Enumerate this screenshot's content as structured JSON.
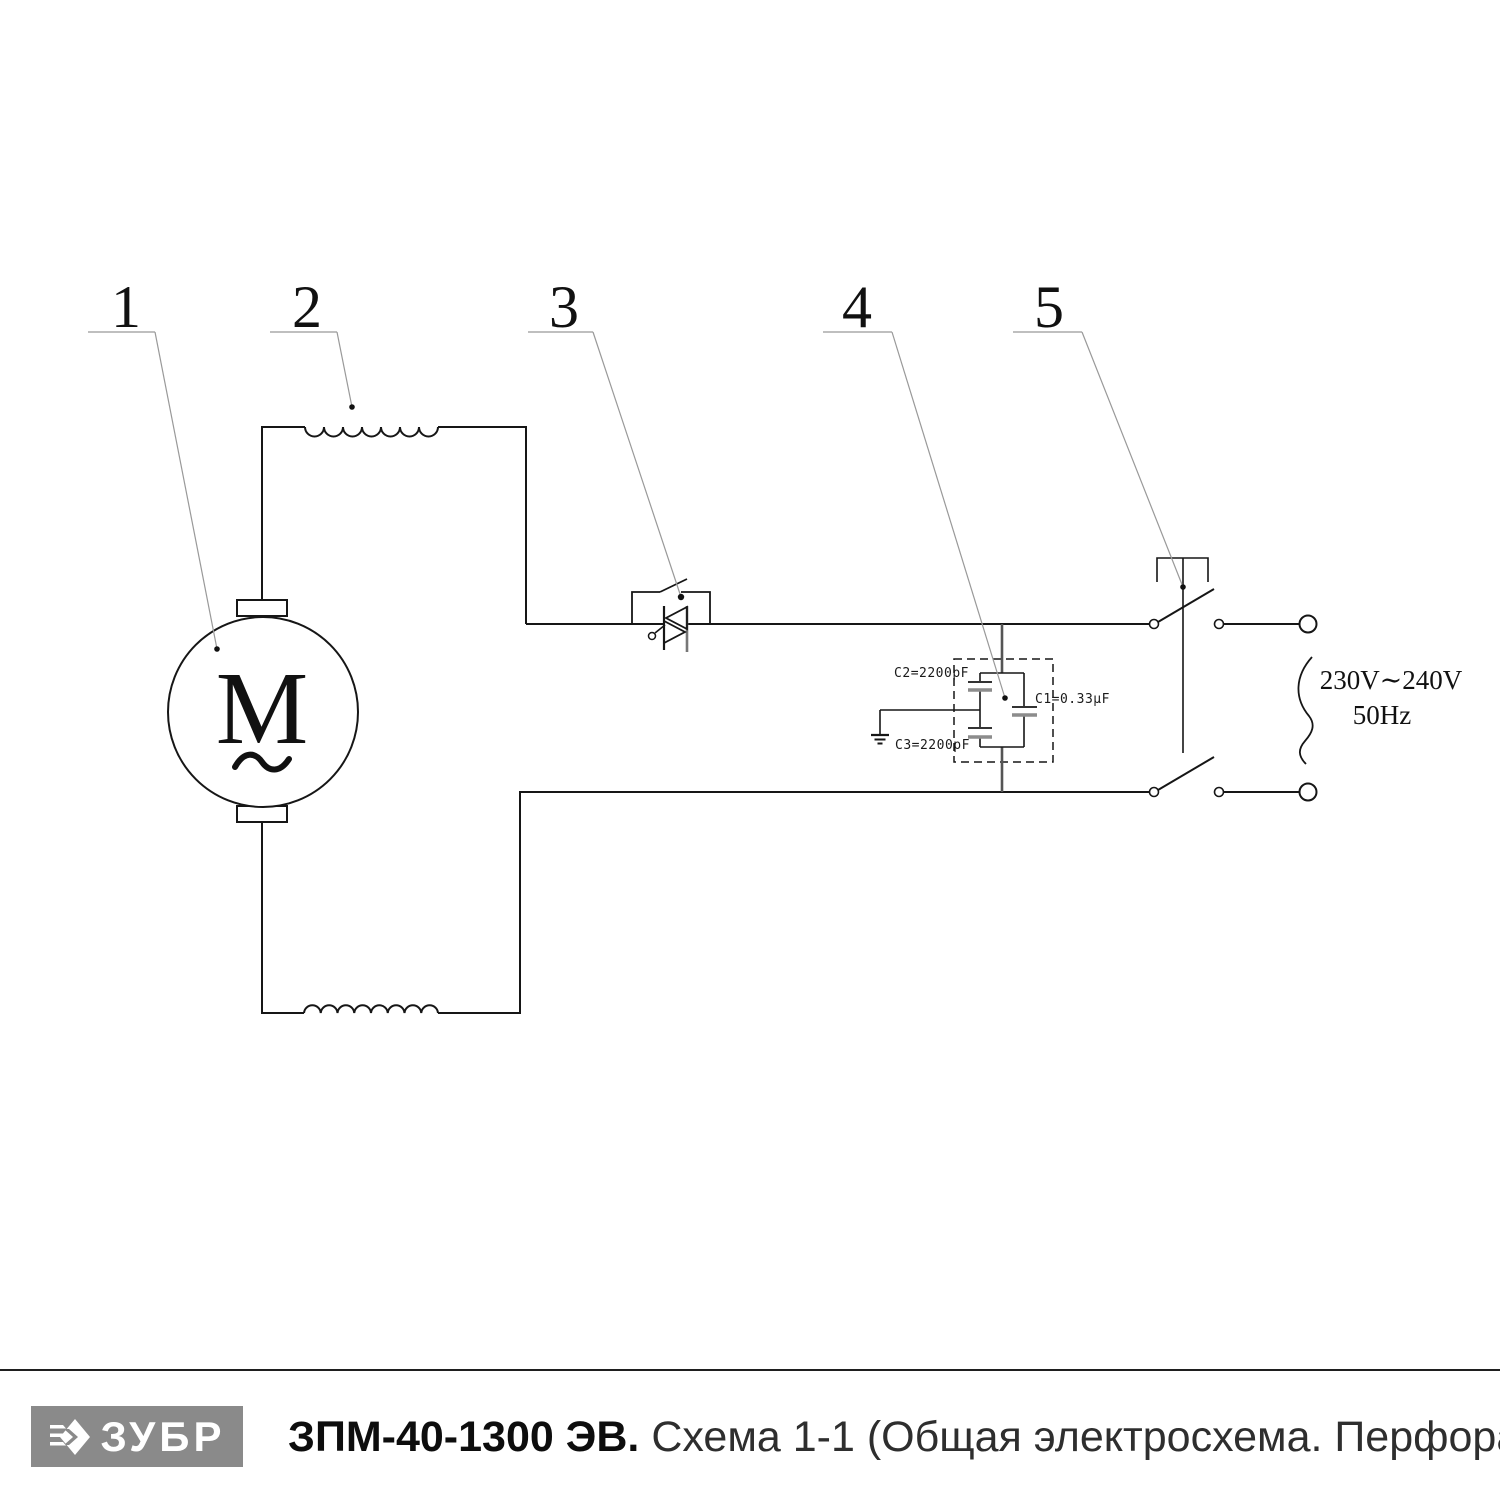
{
  "callouts": {
    "n1": "1",
    "n2": "2",
    "n3": "3",
    "n4": "4",
    "n5": "5"
  },
  "motor": {
    "letter": "M"
  },
  "capacitor_labels": {
    "c2": "C2=2200pF",
    "c3": "C3=2200pF",
    "c1": "C1=0.33µF"
  },
  "power_supply": {
    "voltage": "230V∼240V",
    "frequency": "50Hz"
  },
  "footer": {
    "brand": "ЗУБР",
    "model": "ЗПМ-40-1300 ЭВ.",
    "subtitle": "Схема 1-1 (Общая электросхема. Перфоратор)"
  },
  "colors": {
    "line": "#161616",
    "leader": "#999999",
    "gray_plate": "#8c8c8c",
    "logo_bg": "#8a8a8a",
    "divider": "#1f1f1f"
  }
}
